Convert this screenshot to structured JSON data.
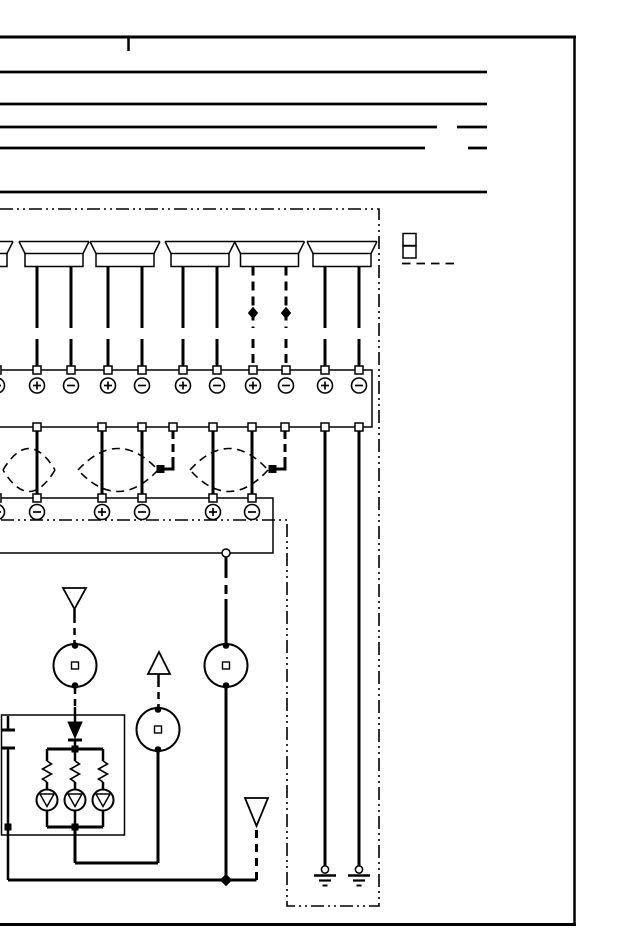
{
  "page": {
    "kind": "scanned wiring diagram page",
    "ink": "#000000",
    "paper": "#ffffff"
  },
  "header": {
    "top_border": {
      "y": 37,
      "x1": 0,
      "x2": 576,
      "w": 3
    },
    "tick": {
      "x": 128.5,
      "y1": 37,
      "y2": 51
    },
    "right_border": {
      "x": 574.5,
      "y1": 36,
      "y2": 925
    },
    "bottom_border": {
      "y": 924.5,
      "x1": 0,
      "x2": 576,
      "w": 3
    },
    "rules": [
      {
        "y": 72,
        "x1": 0,
        "x2": 487
      },
      {
        "y": 104,
        "x1": 0,
        "x2": 487
      },
      {
        "y": 127,
        "x1": 0,
        "x2": 437
      },
      {
        "y": 127,
        "x1": 457,
        "x2": 487
      },
      {
        "y": 148,
        "x1": 0,
        "x2": 425
      },
      {
        "y": 148,
        "x1": 468,
        "x2": 487
      },
      {
        "y": 192,
        "x1": 0,
        "x2": 487
      }
    ]
  },
  "boundary": {
    "path": "M 0 209 L 379 209 L 379 906 L 287 906 L 287 520 L 0 520",
    "dash": "13 4 2 4 2 4"
  },
  "connector_block": {
    "x": 403,
    "y": 233.5,
    "cell_w": 13,
    "cell_h": 12,
    "cells": 2,
    "dash_line": {
      "y": 263.5,
      "x1": 402,
      "x2": 459,
      "dash": "8.5 6"
    }
  },
  "speakers": [
    {
      "id": "speaker-1",
      "cx": -22,
      "leads": [],
      "dashed": false,
      "partial": true
    },
    {
      "id": "speaker-2",
      "cx": 54,
      "leads": [
        37,
        71
      ],
      "dashed": false
    },
    {
      "id": "speaker-3",
      "cx": 125,
      "leads": [
        108,
        142
      ],
      "dashed": false
    },
    {
      "id": "speaker-4",
      "cx": 200,
      "leads": [
        183,
        217
      ],
      "dashed": false
    },
    {
      "id": "speaker-5",
      "cx": 269.5,
      "leads": [
        253,
        286
      ],
      "dashed": true
    },
    {
      "id": "speaker-6",
      "cx": 342,
      "leads": [
        325,
        359
      ],
      "dashed": false
    }
  ],
  "upper_strip": {
    "box": {
      "x": -12,
      "y": 370,
      "w": 384,
      "h": 57
    },
    "terminals": [
      {
        "x": -3,
        "sign": "−"
      },
      {
        "x": 37,
        "sign": "+"
      },
      {
        "x": 71,
        "sign": "−"
      },
      {
        "x": 108,
        "sign": "+"
      },
      {
        "x": 142,
        "sign": "−"
      },
      {
        "x": 183,
        "sign": "+"
      },
      {
        "x": 217,
        "sign": "−"
      },
      {
        "x": 253,
        "sign": "+"
      },
      {
        "x": 286,
        "sign": "−"
      },
      {
        "x": 325,
        "sign": "+"
      },
      {
        "x": 359,
        "sign": "−"
      }
    ],
    "bottom_pins": [
      37,
      102,
      142,
      173,
      213,
      252,
      285,
      325,
      359
    ]
  },
  "pair_wires": [
    37,
    102,
    142,
    213,
    252
  ],
  "shields": [
    {
      "x1": 3,
      "x2": 55
    },
    {
      "x1": 78,
      "x2": 158
    },
    {
      "x1": 190,
      "x2": 268
    }
  ],
  "drains": [
    {
      "from_x": 173,
      "tip_x": 160.5
    },
    {
      "from_x": 285,
      "tip_x": 272.5
    }
  ],
  "lower_strip": {
    "box": {
      "x": -12,
      "y": 498,
      "w": 285,
      "h": 55
    },
    "terminals": [
      {
        "x": -3,
        "sign": "+"
      },
      {
        "x": 37,
        "sign": "−"
      },
      {
        "x": 102,
        "sign": "+"
      },
      {
        "x": 142,
        "sign": "−"
      },
      {
        "x": 213,
        "sign": "+"
      },
      {
        "x": 252,
        "sign": "−"
      }
    ],
    "out_pin": {
      "x": 226,
      "y": 553
    }
  },
  "ground_wires": [
    {
      "x": 325
    },
    {
      "x": 359
    }
  ],
  "inline_connectors": [
    {
      "cx": 75,
      "cy": 665.5
    },
    {
      "cx": 158,
      "cy": 729.5
    },
    {
      "cx": 226,
      "cy": 665.5
    }
  ],
  "offpage_arrows": [
    {
      "id": "arrow-1",
      "dir": "down",
      "cx": 74.5,
      "y_top": 588,
      "h": 21,
      "w": 23
    },
    {
      "id": "arrow-2",
      "dir": "up",
      "cx": 159,
      "y_top": 652,
      "h": 22,
      "w": 22
    },
    {
      "id": "arrow-3",
      "dir": "down",
      "cx": 256.5,
      "y_top": 798,
      "h": 28,
      "w": 23
    }
  ],
  "lamp_unit": {
    "box": {
      "x": 1.5,
      "y": 715,
      "w": 123,
      "h": 120
    },
    "branches": [
      47,
      75,
      103
    ]
  },
  "extra_wires": [
    [
      "l",
      74.5,
      609,
      74.5,
      616,
      2.5,
      null
    ],
    [
      "l",
      74.5,
      616,
      74.5,
      644,
      2.5,
      "7 5"
    ],
    [
      "l",
      75,
      687,
      75,
      707,
      2.5,
      "7 5"
    ],
    [
      "l",
      75,
      707,
      75,
      722,
      2.5,
      null
    ],
    [
      "l",
      158.5,
      674,
      158.5,
      680,
      2.5,
      null
    ],
    [
      "l",
      158.5,
      680,
      158.5,
      708,
      2.5,
      "7 5"
    ],
    [
      "l",
      158,
      751,
      158,
      863,
      3,
      null
    ],
    [
      "l",
      158,
      863,
      75,
      863,
      3,
      null
    ],
    [
      "l",
      75,
      827,
      75,
      863,
      3,
      null
    ],
    [
      "l",
      226,
      557,
      226,
      569,
      3,
      null
    ],
    [
      "l",
      226,
      569,
      226,
      599,
      3,
      "9 7"
    ],
    [
      "l",
      226,
      599,
      226,
      644,
      3,
      null
    ],
    [
      "l",
      226,
      687,
      226,
      880,
      3,
      null
    ],
    [
      "pg",
      "226,874.5 231.5,880 226,885.5 220.5,880",
      "b",
      1
    ],
    [
      "l",
      8,
      880,
      256.5,
      880,
      3,
      null
    ],
    [
      "l",
      256.5,
      880,
      256.5,
      827,
      3,
      "8 6"
    ],
    [
      "l",
      8,
      716,
      8,
      728.5,
      2.5,
      null
    ],
    [
      "l",
      1,
      730,
      15,
      730,
      3,
      null
    ],
    [
      "l",
      1,
      748,
      15,
      748,
      3,
      null
    ],
    [
      "l",
      8,
      749.5,
      8,
      880,
      2.5,
      null
    ],
    [
      "r",
      5,
      824,
      6,
      6,
      1,
      "b"
    ],
    [
      "pg",
      "68,722 82,722 75,738",
      "b",
      1
    ],
    [
      "l",
      68,
      740,
      82,
      740,
      3,
      null
    ],
    [
      "l",
      75,
      741,
      75,
      749,
      2.5,
      null
    ],
    [
      "r",
      72,
      746,
      6,
      6,
      1,
      "b"
    ],
    [
      "l",
      47,
      749,
      103,
      749,
      3,
      null
    ],
    [
      "l",
      47,
      827,
      103,
      827,
      3,
      null
    ],
    [
      "r",
      72,
      824,
      6,
      6,
      1,
      "b"
    ]
  ]
}
